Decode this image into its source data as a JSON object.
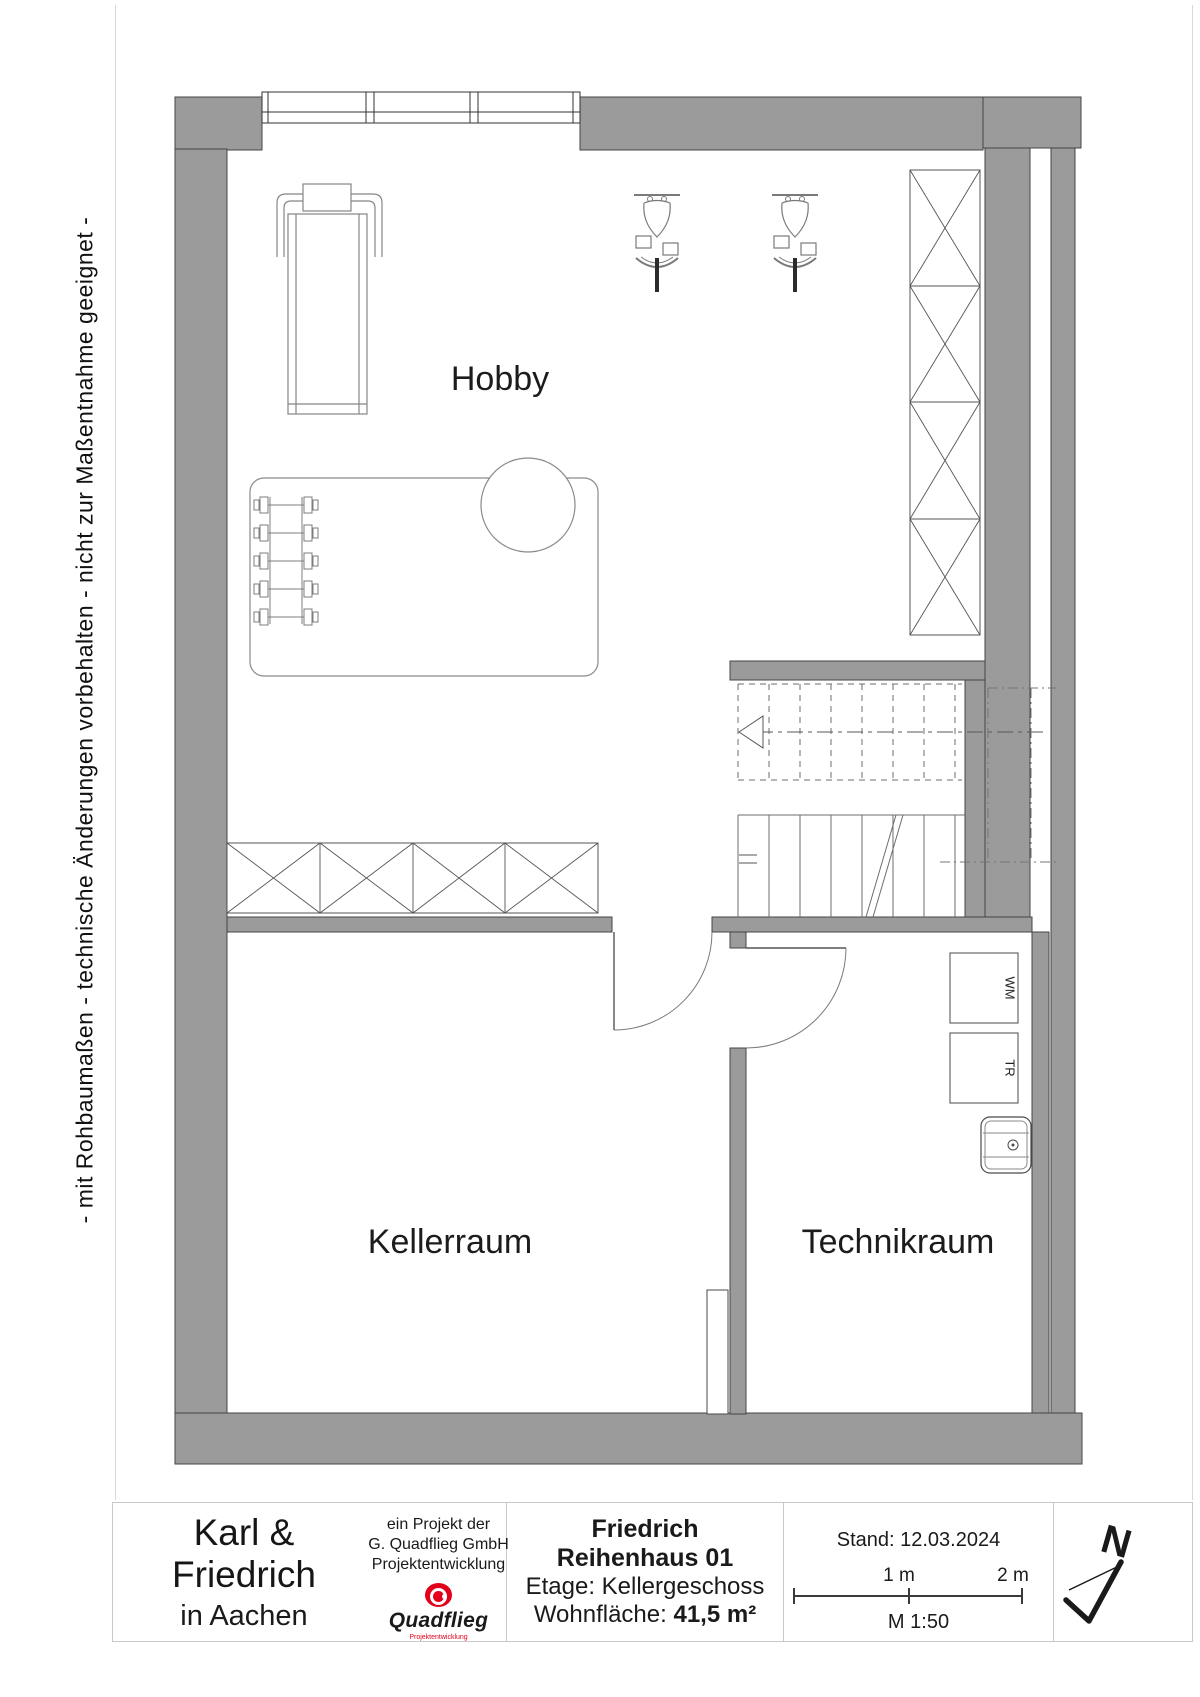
{
  "margin_note": "- mit Rohbaumaßen - technische Änderungen vorbehalten - nicht zur Maßentnahme geeignet -",
  "plan": {
    "room_labels": {
      "hobby": "Hobby",
      "kellerraum": "Kellerraum",
      "technikraum": "Technikraum"
    },
    "appliance_labels": {
      "washing_machine": "WM",
      "dryer": "TR"
    }
  },
  "title_block": {
    "client_name": "Karl & Friedrich",
    "client_city": "in Aachen",
    "company_line1": "ein Projekt der",
    "company_line2": "G. Quadflieg GmbH",
    "company_line3": "Projektentwicklung",
    "logo_name": "Quadflieg",
    "logo_subtitle": "Projektentwicklung",
    "project_name": "Friedrich",
    "project_house": "Reihenhaus 01",
    "floor_line": "Etage: Kellergeschoss",
    "area_label": "Wohnfläche:",
    "area_value": "41,5 m²",
    "date_line": "Stand: 12.03.2024",
    "scale_tick_1": "1 m",
    "scale_tick_2": "2 m",
    "scale_text": "M 1:50",
    "north_letter": "N"
  },
  "colors": {
    "wall_gray": "#9b9b9b",
    "logo_red": "#e2001a"
  }
}
